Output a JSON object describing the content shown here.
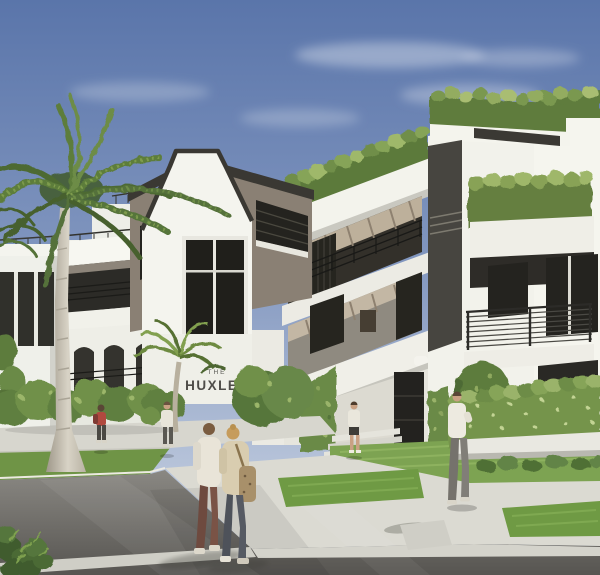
{
  "scene": {
    "type": "architectural-rendering",
    "description": "Sunny exterior rendering of a modern three-story white condominium with rooftop greenery, deep balconies, black metal railings and palm trees; pedestrians cross the plaza and street in front.",
    "sign": {
      "prefix": "THE",
      "name": "HUXLEY"
    },
    "palette": {
      "sky_top": "#5a75aa",
      "sky_horizon": "#cfd8e5",
      "wall_white": "#f2f1ec",
      "wall_shade": "#d8d8d0",
      "panel_taupe": "#8a8074",
      "window_glass": "#24231f",
      "railing_metal": "#2b2a27",
      "wood_ceiling": "#c2b6a2",
      "foliage_dark": "#4d6a33",
      "foliage_light": "#9ab36a",
      "lawn": "#7da352",
      "concrete": "#dbdad2",
      "asphalt": "#6e6c67"
    },
    "people": [
      {
        "label": "couple walking in foreground"
      },
      {
        "label": "man standing by right hedge"
      },
      {
        "label": "person in red top walking at left"
      },
      {
        "label": "person walking near palm tree"
      },
      {
        "label": "resident at entrance steps"
      }
    ]
  }
}
